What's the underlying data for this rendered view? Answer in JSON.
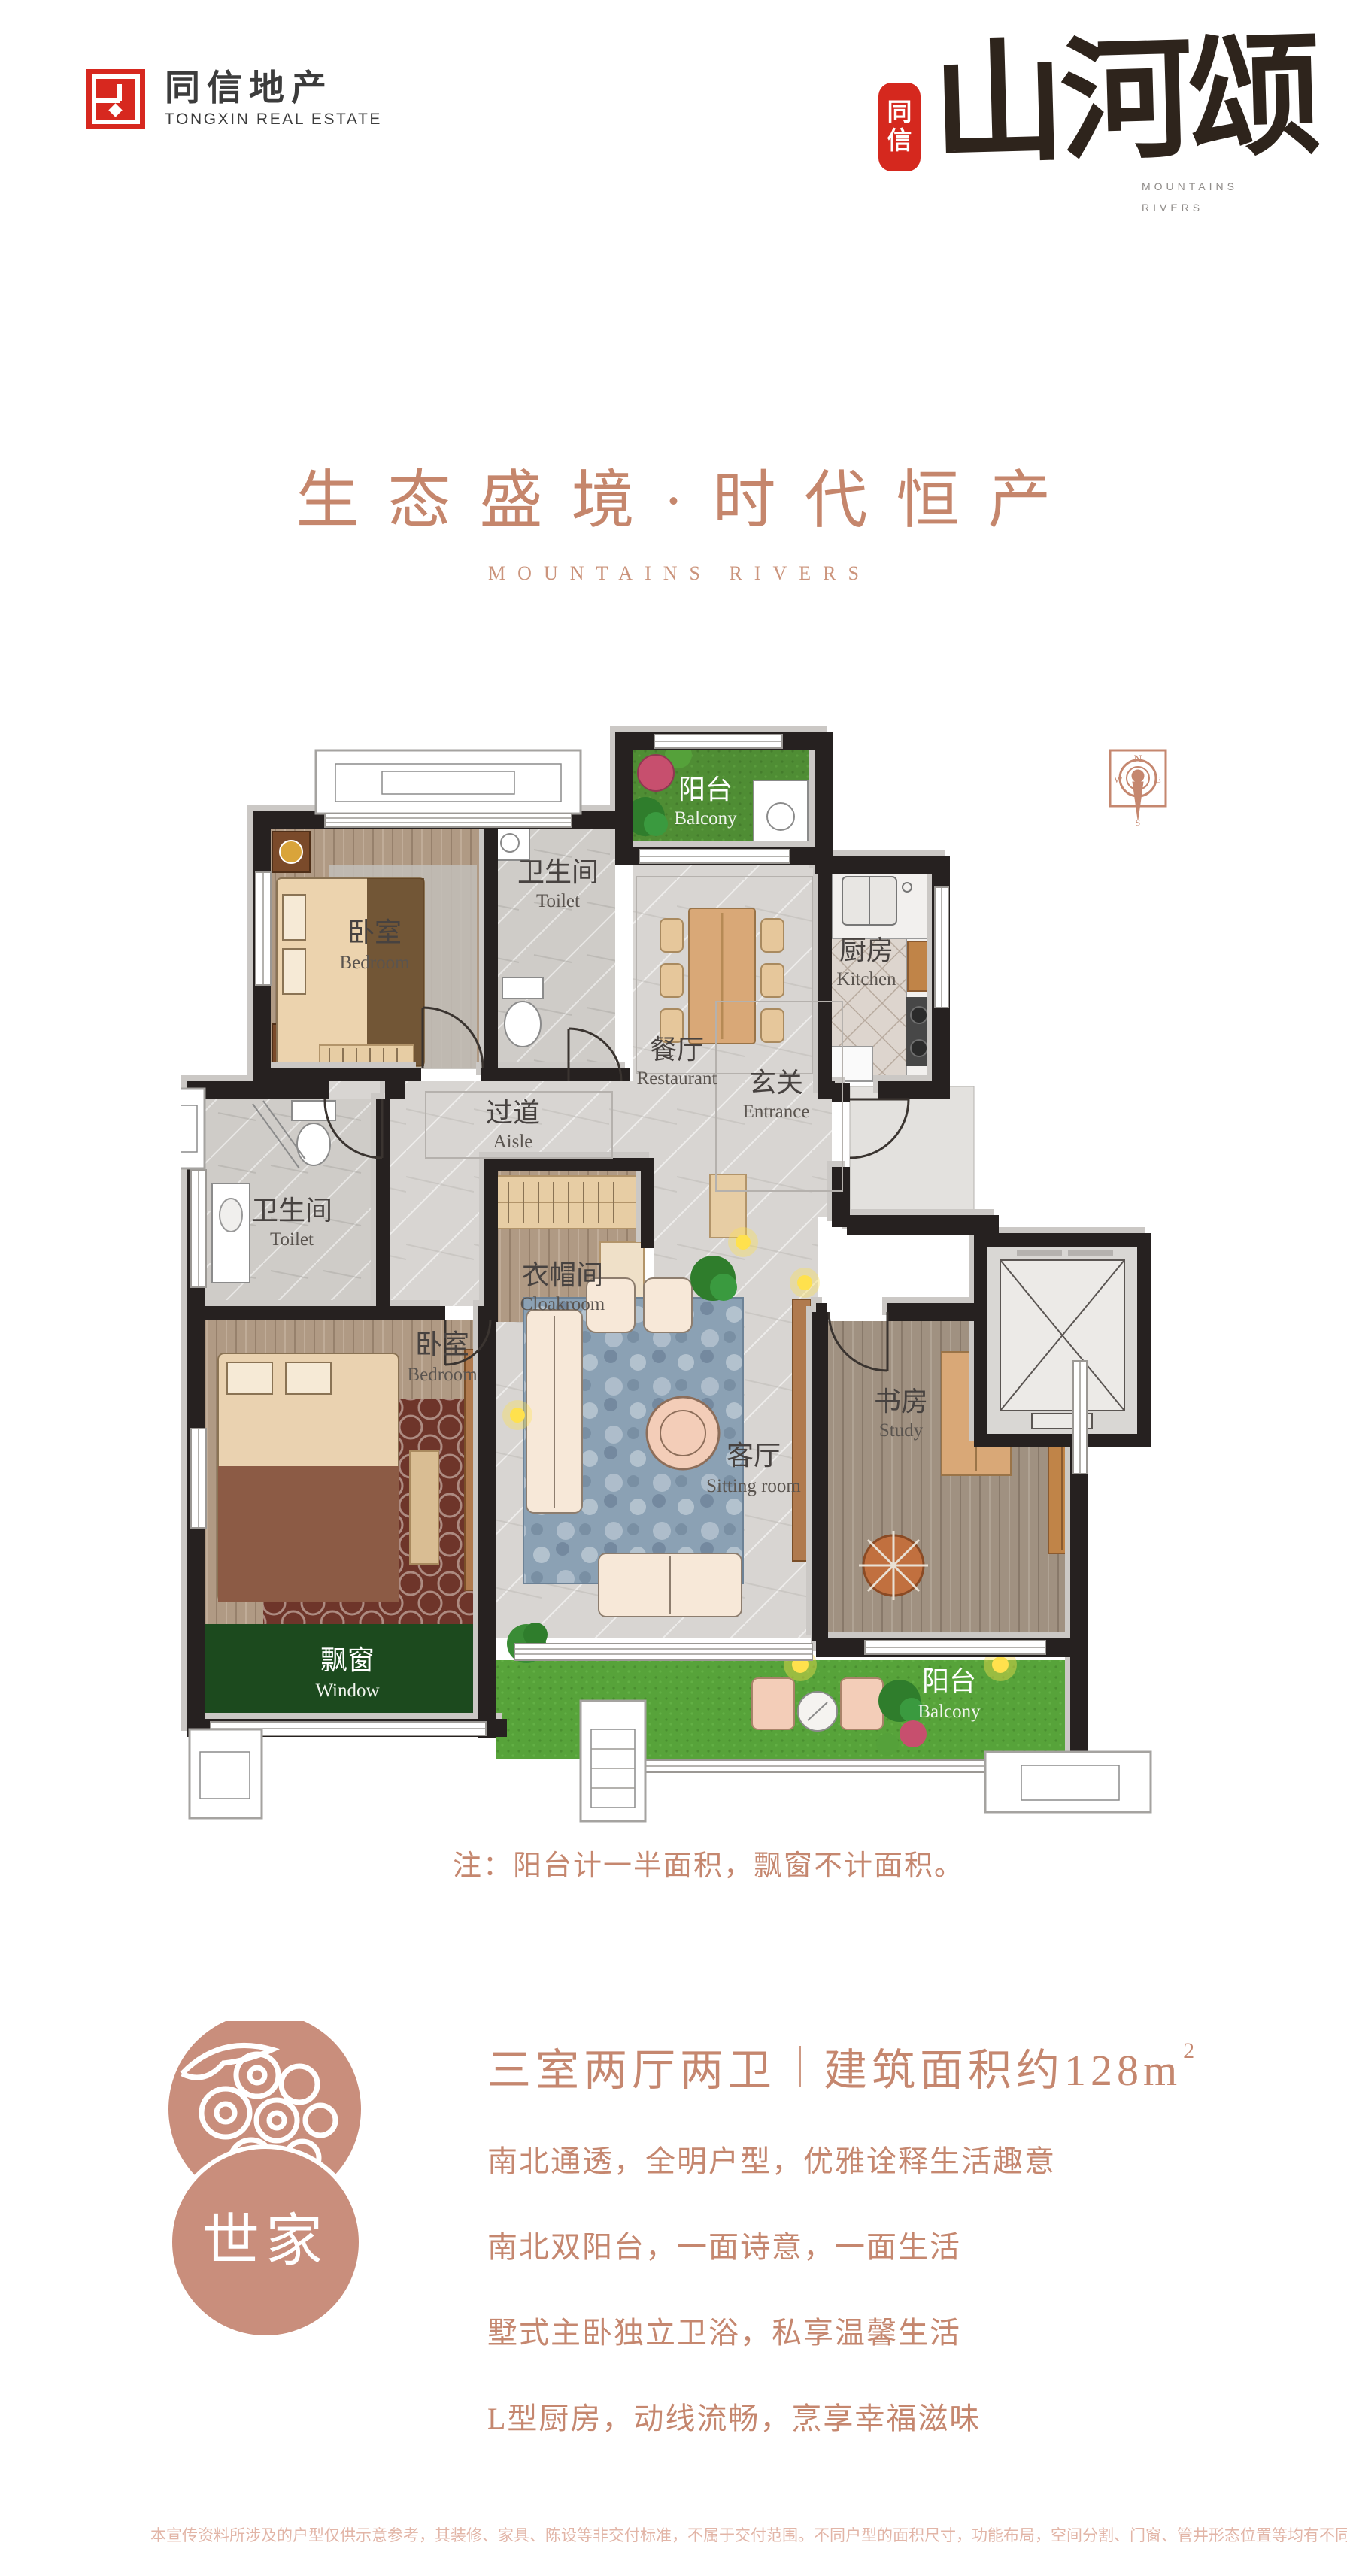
{
  "header": {
    "logo": {
      "zh": "同信地产",
      "en": "TONGXIN REAL ESTATE",
      "mark_color": "#d7281f"
    },
    "brand": {
      "seal_line1": "同",
      "seal_line2": "信",
      "calligraphy": "山河颂",
      "en_line1": "MOUNTAINS",
      "en_line2": "RIVERS"
    }
  },
  "hero": {
    "title": "生态盛境·时代恒产",
    "subtitle": "MOUNTAINS RIVERS",
    "accent_color": "#c5866c"
  },
  "plan": {
    "compass": {
      "n": "N",
      "e": "E",
      "s": "S",
      "w": "W"
    },
    "rooms": [
      {
        "id": "bedroom1",
        "zh": "卧室",
        "en": "Bedroom"
      },
      {
        "id": "toilet1",
        "zh": "卫生间",
        "en": "Toilet"
      },
      {
        "id": "balcony-top",
        "zh": "阳台",
        "en": "Balcony"
      },
      {
        "id": "restaurant",
        "zh": "餐厅",
        "en": "Restaurant"
      },
      {
        "id": "kitchen",
        "zh": "厨房",
        "en": "Kitchen"
      },
      {
        "id": "aisle",
        "zh": "过道",
        "en": "Aisle"
      },
      {
        "id": "entrance",
        "zh": "玄关",
        "en": "Entrance"
      },
      {
        "id": "toilet2",
        "zh": "卫生间",
        "en": "Toilet"
      },
      {
        "id": "cloakroom",
        "zh": "衣帽间",
        "en": "Cloakroom"
      },
      {
        "id": "bedroom2",
        "zh": "卧室",
        "en": "Bedroom"
      },
      {
        "id": "bay-window",
        "zh": "飘窗",
        "en": "Window"
      },
      {
        "id": "sitting-room",
        "zh": "客厅",
        "en": "Sitting room"
      },
      {
        "id": "study",
        "zh": "书房",
        "en": "Study"
      },
      {
        "id": "balcony-bottom",
        "zh": "阳台",
        "en": "Balcony"
      }
    ],
    "note": "注：阳台计一半面积，飘窗不计面积。"
  },
  "details": {
    "emblem": "世家",
    "spec_left": "三室两厅两卫",
    "spec_right": "建筑面积约128m",
    "spec_sup": "2",
    "features": [
      "南北通透，全明户型，优雅诠释生活趣意",
      "南北双阳台，一面诗意，一面生活",
      "墅式主卧独立卫浴，私享温馨生活",
      "L型厨房，动线流畅，烹享幸福滋味"
    ]
  },
  "footer": {
    "disclaimer": "本宣传资料所涉及的户型仅供示意参考，其装修、家具、陈设等非交付标准，不属于交付范围。不同户型的面积尺寸，功能布局，空间分割、门窗、管井形态位置等均有不同；相同户型因楼栋、楼层、单元等差别，局部结构、面积等也可能不同，具体以政府部门最终审定的图纸和销售合同为准。"
  }
}
